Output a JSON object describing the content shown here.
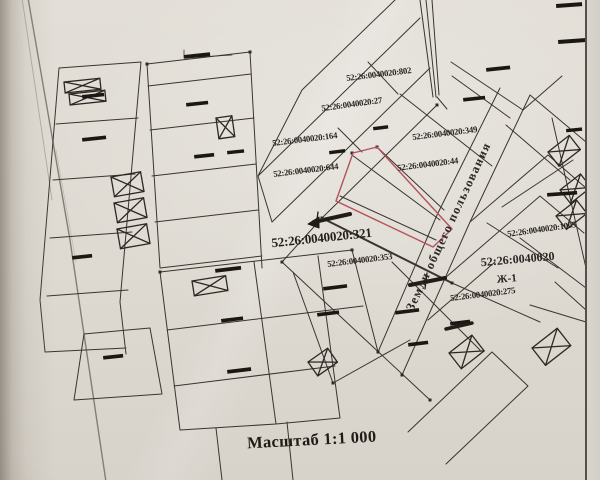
{
  "map": {
    "colors": {
      "paper": "#dedad2",
      "ink": "#37322c",
      "highlight_outline": "#b5515a",
      "redaction": "#1b1713"
    },
    "labels": {
      "parcel_802": "52:26:0040020:802",
      "parcel_27": "52:26:0040020:27",
      "parcel_349": "52:26:0040020:349",
      "parcel_164": "52:26:0040020:164",
      "parcel_44": "52:26:0040020:44",
      "parcel_644": "52:26:0040020:644",
      "parcel_321": "52:26:0040020:321",
      "parcel_353": "52:26:0040020:353",
      "parcel_1005": "52:26:0040020:1005",
      "parcel_275": "52:26:0040020:275",
      "quarter": "52:26:0040020",
      "zone": "Ж-1",
      "public_land": "Земли общего пользования"
    },
    "scale_label": "Масштаб 1:1 000"
  }
}
